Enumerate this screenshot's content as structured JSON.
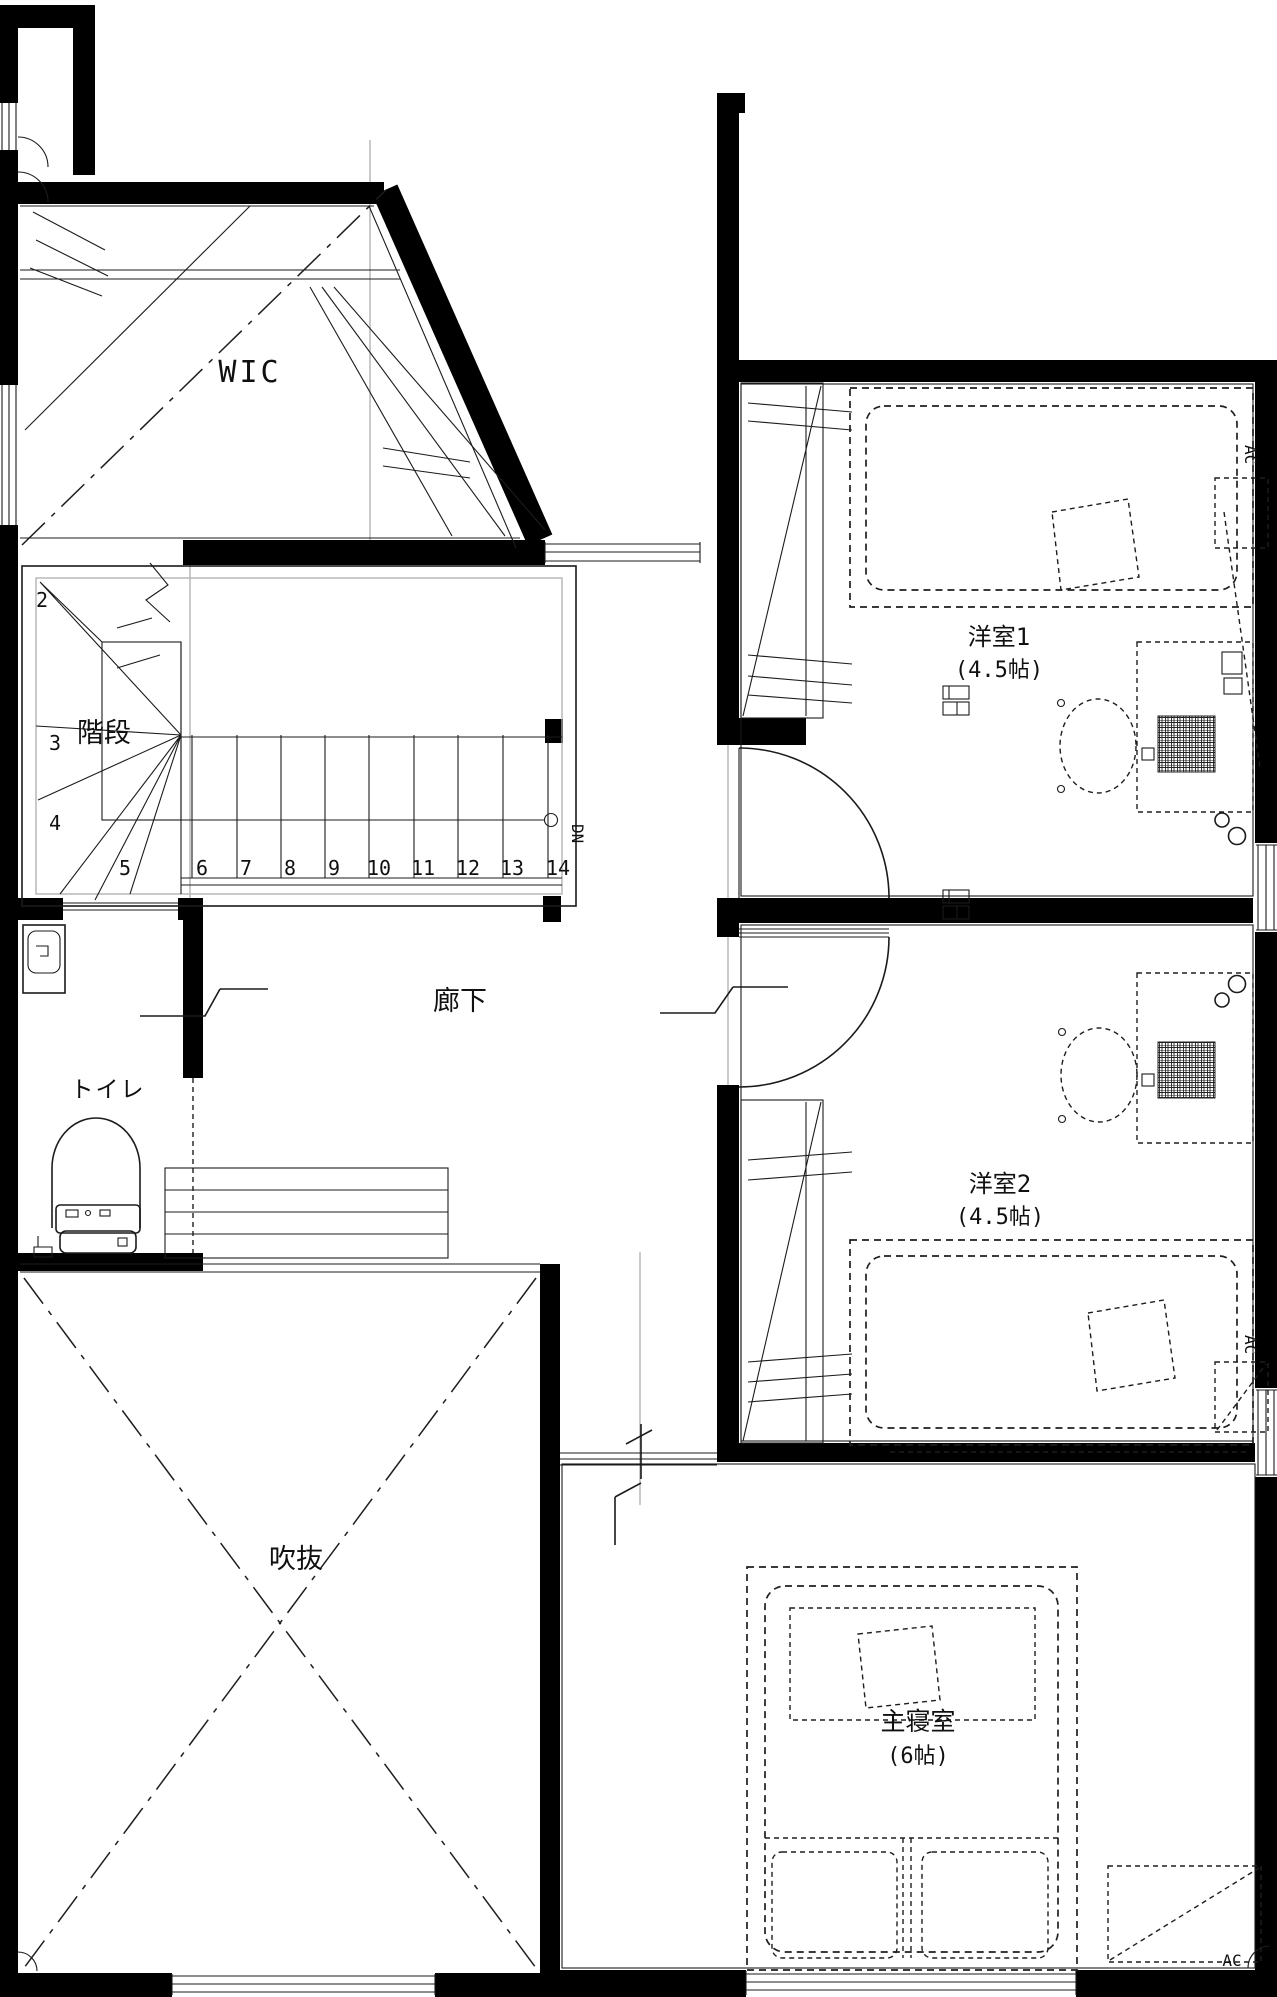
{
  "drawing": {
    "type": "floor-plan",
    "floor": "2F"
  },
  "colors": {
    "wall": "#000000",
    "line": "#1b1b1b",
    "grid": "#aeaeae",
    "background": "#ffffff"
  },
  "rooms": {
    "wic": {
      "label": "WIC"
    },
    "stairs": {
      "label": "階段"
    },
    "hallway": {
      "label": "廊下"
    },
    "toilet": {
      "label": "トイレ"
    },
    "void": {
      "label": "吹抜"
    },
    "bedroom1": {
      "label": "洋室1",
      "size": "(4.5帖)"
    },
    "bedroom2": {
      "label": "洋室2",
      "size": "(4.5帖)"
    },
    "master": {
      "label": "主寝室",
      "size": "(6帖)"
    }
  },
  "stairs": {
    "numbers": [
      "2",
      "3",
      "4",
      "5",
      "6",
      "7",
      "8",
      "9",
      "10",
      "11",
      "12",
      "13",
      "14"
    ],
    "down_label": "DN"
  },
  "equipment": {
    "ac": "AC"
  }
}
